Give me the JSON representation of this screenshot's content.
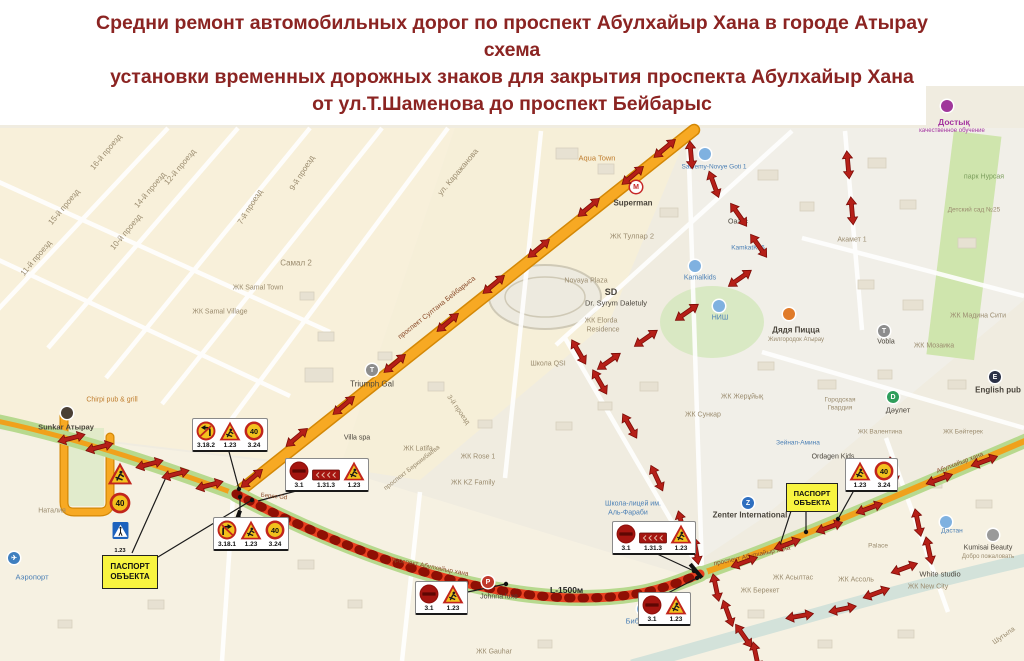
{
  "title": {
    "line1": "Средни ремонт автомобильных дорог по проспект Абулхайыр Хана в городе Атырау",
    "line2": "схема",
    "line3": "установки временных дорожных знаков для закрытия проспекта Абулхайыр Хана",
    "line4": "от ул.Т.Шаменова до проспект Бейбарыс"
  },
  "legend": {
    "passport_line1": "ПАСПОРТ",
    "passport_line2": "ОБЪЕКТА",
    "closure_length": "L-1500м"
  },
  "colors": {
    "title_text": "#8b2422",
    "road_closed": "#e8401f",
    "road_main_orange": "#f7a923",
    "road_verge_green": "#b7d98e",
    "detour_arrow": "#b51f18",
    "passport_bg": "#f8f440",
    "sign_temporary_bg": "#f2c11d",
    "sign_red": "#c1251c"
  },
  "roads": {
    "beibarys": "проспект Султана Бейбарыса",
    "abulkhair": "проспект Абулхайыр хана"
  },
  "sign_clusters": [
    {
      "x": 192,
      "y": 418,
      "signs": [
        {
          "t": "no-left-turn",
          "n": "3.18.2"
        },
        {
          "t": "roadworks",
          "n": "1.23"
        },
        {
          "t": "speed",
          "n": "3.24",
          "v": "40"
        }
      ]
    },
    {
      "x": 285,
      "y": 458,
      "signs": [
        {
          "t": "no-entry",
          "n": "3.1"
        },
        {
          "t": "panel",
          "n": "1.31.3"
        },
        {
          "t": "roadworks",
          "n": "1.23"
        }
      ]
    },
    {
      "x": 213,
      "y": 517,
      "signs": [
        {
          "t": "no-right-turn",
          "n": "3.18.1"
        },
        {
          "t": "roadworks",
          "n": "1.23"
        },
        {
          "t": "speed",
          "n": "3.24",
          "v": "40"
        }
      ]
    },
    {
      "x": 612,
      "y": 521,
      "signs": [
        {
          "t": "no-entry",
          "n": "3.1"
        },
        {
          "t": "panel",
          "n": "1.31.3"
        },
        {
          "t": "roadworks",
          "n": "1.23"
        }
      ]
    },
    {
      "x": 415,
      "y": 581,
      "signs": [
        {
          "t": "no-entry",
          "n": "3.1"
        },
        {
          "t": "roadworks",
          "n": "1.23"
        }
      ]
    },
    {
      "x": 638,
      "y": 592,
      "signs": [
        {
          "t": "no-entry",
          "n": "3.1"
        },
        {
          "t": "roadworks",
          "n": "1.23"
        }
      ]
    },
    {
      "x": 845,
      "y": 458,
      "signs": [
        {
          "t": "roadworks",
          "n": "1.23"
        },
        {
          "t": "speed",
          "n": "3.24",
          "v": "40"
        }
      ]
    }
  ],
  "sign_stack": {
    "x": 107,
    "y": 462,
    "signs": [
      {
        "t": "roadworks",
        "n": "1.23"
      },
      {
        "t": "speed",
        "n": "3.24",
        "v": "40"
      },
      {
        "t": "ped-crossing",
        "n": "5.19.1"
      }
    ],
    "list": [
      "1.23",
      "3.24",
      "5.19.1"
    ]
  },
  "passport_boxes": [
    {
      "x": 102,
      "y": 555,
      "w": 54,
      "h": 32
    },
    {
      "x": 786,
      "y": 483,
      "w": 50,
      "h": 27
    }
  ],
  "distance": {
    "x": 550,
    "y": 585
  },
  "labels": [
    {
      "t": "16-й проезд",
      "x": 106,
      "y": 152,
      "r": -50
    },
    {
      "t": "15-й проезд",
      "x": 64,
      "y": 207,
      "r": -50
    },
    {
      "t": "14-й проезд",
      "x": 150,
      "y": 190,
      "r": -50
    },
    {
      "t": "12-й проезд",
      "x": 180,
      "y": 167,
      "r": -50
    },
    {
      "t": "11-й проезд",
      "x": 36,
      "y": 258,
      "r": -50
    },
    {
      "t": "10-й проезд",
      "x": 126,
      "y": 232,
      "r": -50
    },
    {
      "t": "9-й проезд",
      "x": 302,
      "y": 173,
      "r": -58
    },
    {
      "t": "7-й проезд",
      "x": 250,
      "y": 207,
      "r": -58
    },
    {
      "t": "Самал 2",
      "x": 296,
      "y": 263
    },
    {
      "t": "ЖК Samal Town",
      "x": 258,
      "y": 288,
      "fs": 7
    },
    {
      "t": "ЖК Samal Village",
      "x": 220,
      "y": 312,
      "fs": 7
    },
    {
      "t": "ул. Каражанова",
      "x": 458,
      "y": 172,
      "r": -50
    },
    {
      "t": "Aqua Town",
      "x": 597,
      "y": 158,
      "c": "poi",
      "fs": 7.5
    },
    {
      "t": "Superman",
      "x": 633,
      "y": 203,
      "c": "dk",
      "b": 1,
      "fs": 8
    },
    {
      "t": "Saulemy-Novye Goti 1",
      "x": 714,
      "y": 167,
      "c": "bl",
      "fs": 6.5
    },
    {
      "t": "ЖК Тулпар 2",
      "x": 632,
      "y": 236,
      "fs": 7.5
    },
    {
      "t": "Оазис",
      "x": 738,
      "y": 222,
      "c": "dk",
      "fs": 7
    },
    {
      "t": "Kamalkids",
      "x": 700,
      "y": 278,
      "c": "bl",
      "fs": 7
    },
    {
      "t": "Novaya Plaza",
      "x": 586,
      "y": 281,
      "fs": 7
    },
    {
      "t": "KamkatK06",
      "x": 748,
      "y": 248,
      "c": "bl",
      "fs": 6.5
    },
    {
      "t": "Акамет 1",
      "x": 852,
      "y": 240,
      "fs": 7
    },
    {
      "t": "Достық",
      "x": 954,
      "y": 122,
      "c": "pu",
      "b": 1,
      "fs": 8.5
    },
    {
      "t": "качественное обучение",
      "x": 952,
      "y": 131,
      "c": "pu",
      "fs": 6
    },
    {
      "t": "парк Нурсая",
      "x": 984,
      "y": 177,
      "c": "grn",
      "fs": 7
    },
    {
      "t": "Детский сад №25",
      "x": 974,
      "y": 210,
      "fs": 6.5
    },
    {
      "t": "ЖК Мәдина Сити",
      "x": 978,
      "y": 316,
      "fs": 7
    },
    {
      "t": "Vobla",
      "x": 886,
      "y": 342,
      "c": "dk",
      "fs": 7
    },
    {
      "t": "ЖК Мозаика",
      "x": 934,
      "y": 346,
      "fs": 7
    },
    {
      "t": "English pub",
      "x": 998,
      "y": 390,
      "c": "dk",
      "b": 1,
      "fs": 8
    },
    {
      "t": "Дәулет",
      "x": 898,
      "y": 410,
      "c": "dk",
      "fs": 7.5
    },
    {
      "t": "ЖК Валентина",
      "x": 880,
      "y": 432,
      "fs": 6.5
    },
    {
      "t": "ЖК Бәйтерек",
      "x": 963,
      "y": 432,
      "fs": 6.5
    },
    {
      "t": "Triumph Gal",
      "x": 372,
      "y": 384,
      "c": "dk",
      "fs": 8
    },
    {
      "t": "Villa spa",
      "x": 357,
      "y": 438,
      "c": "dk",
      "fs": 7
    },
    {
      "t": "ЖК Latifa",
      "x": 418,
      "y": 449,
      "fs": 7
    },
    {
      "t": "ЖК Rose 1",
      "x": 478,
      "y": 457,
      "fs": 7
    },
    {
      "t": "3-й проезд",
      "x": 458,
      "y": 410,
      "r": 55,
      "fs": 7
    },
    {
      "t": "Школа QSI",
      "x": 548,
      "y": 364,
      "fs": 7
    },
    {
      "t": "SD",
      "x": 611,
      "y": 292,
      "c": "dk",
      "b": 1,
      "fs": 9
    },
    {
      "t": "Dr. Syrym Daletuly",
      "x": 616,
      "y": 303,
      "c": "dk",
      "fs": 7.5
    },
    {
      "t": "ЖК Elorda",
      "x": 601,
      "y": 321,
      "fs": 7
    },
    {
      "t": "Residence",
      "x": 603,
      "y": 330,
      "fs": 7
    },
    {
      "t": "НИШ",
      "x": 720,
      "y": 318,
      "c": "bl",
      "fs": 7
    },
    {
      "t": "Дядя Пицца",
      "x": 796,
      "y": 330,
      "c": "dk",
      "b": 1,
      "fs": 8
    },
    {
      "t": "Жилгородок Атырау",
      "x": 796,
      "y": 340,
      "fs": 6
    },
    {
      "t": "ЖК Жерұйық",
      "x": 742,
      "y": 397,
      "fs": 7
    },
    {
      "t": "ЖК Сункар",
      "x": 703,
      "y": 415,
      "fs": 7
    },
    {
      "t": "Городская",
      "x": 840,
      "y": 400,
      "fs": 6.5
    },
    {
      "t": "Гвардия",
      "x": 840,
      "y": 408,
      "fs": 6.5
    },
    {
      "t": "Зейнап-Амина",
      "x": 798,
      "y": 443,
      "c": "bl",
      "fs": 6.5
    },
    {
      "t": "Ordagen Kids",
      "x": 833,
      "y": 457,
      "c": "dk",
      "fs": 7
    },
    {
      "t": "ЖК KZ Family",
      "x": 473,
      "y": 483,
      "fs": 7
    },
    {
      "t": "проспект Беркимбаева",
      "x": 412,
      "y": 468,
      "r": -38,
      "fs": 6.5
    },
    {
      "t": "Школа-лицей им.",
      "x": 633,
      "y": 504,
      "c": "bl",
      "fs": 7
    },
    {
      "t": "Аль-Фараби",
      "x": 628,
      "y": 513,
      "c": "bl",
      "fs": 7
    },
    {
      "t": "Zenter International",
      "x": 750,
      "y": 515,
      "c": "dk",
      "b": 1,
      "fs": 8
    },
    {
      "t": "Библиотека",
      "x": 646,
      "y": 621,
      "c": "bl",
      "fs": 7.5
    },
    {
      "t": "ЖК Gauhar",
      "x": 494,
      "y": 652,
      "fs": 7
    },
    {
      "t": "Johnna luxe",
      "x": 499,
      "y": 597,
      "c": "dk",
      "fs": 7
    },
    {
      "t": "ЖК Асылтас",
      "x": 793,
      "y": 578,
      "fs": 7
    },
    {
      "t": "ЖК Берекет",
      "x": 760,
      "y": 591,
      "fs": 7
    },
    {
      "t": "Дастан",
      "x": 952,
      "y": 531,
      "c": "bl",
      "fs": 6.5
    },
    {
      "t": "Palace",
      "x": 878,
      "y": 546,
      "fs": 6.5
    },
    {
      "t": "ЖК Ассоль",
      "x": 856,
      "y": 580,
      "fs": 7
    },
    {
      "t": "White studio",
      "x": 940,
      "y": 574,
      "c": "dk",
      "fs": 7.5
    },
    {
      "t": "ЖК New City",
      "x": 928,
      "y": 587,
      "fs": 7
    },
    {
      "t": "Kumisai Beauty",
      "x": 988,
      "y": 548,
      "c": "dk",
      "fs": 7
    },
    {
      "t": "Добро пожаловать",
      "x": 988,
      "y": 557,
      "fs": 6
    },
    {
      "t": "Шугыла",
      "x": 1004,
      "y": 636,
      "r": -35,
      "fs": 7
    },
    {
      "t": "Sunkar Атырау",
      "x": 66,
      "y": 427,
      "c": "dk",
      "b": 1,
      "fs": 7.5
    },
    {
      "t": "Chirpi pub & grill",
      "x": 112,
      "y": 400,
      "c": "poi",
      "fs": 7
    },
    {
      "t": "Наталия",
      "x": 52,
      "y": 511,
      "fs": 7
    },
    {
      "t": "Аэропорт",
      "x": 32,
      "y": 577,
      "c": "bl",
      "fs": 7.5
    },
    {
      "t": "Берес Gd",
      "x": 274,
      "y": 497,
      "c": "rd",
      "fs": 6,
      "r": 6
    },
    {
      "t": "проспект Султана Бейбарыса",
      "x": 437,
      "y": 308,
      "c": "rd",
      "r": -38.5,
      "fs": 7
    },
    {
      "t": "проспект Абулхайыр хана",
      "x": 430,
      "y": 567,
      "c": "rd",
      "r": 11,
      "fs": 6.5
    },
    {
      "t": "проспект Абулхайыр хана",
      "x": 752,
      "y": 556,
      "c": "rd",
      "r": -12,
      "fs": 6.5
    },
    {
      "t": "Абулхайыр хана",
      "x": 960,
      "y": 463,
      "c": "rd",
      "r": -21,
      "fs": 6.5
    }
  ],
  "pois": [
    {
      "g": "M",
      "x": 636,
      "y": 187,
      "bg": "#ffffff",
      "fg": "#c62828",
      "name": "metro-superman-icon"
    },
    {
      "g": "",
      "x": 947,
      "y": 106,
      "bg": "#a0379b",
      "name": "dostyk-icon"
    },
    {
      "g": "T",
      "x": 372,
      "y": 370,
      "bg": "#8d8d8d",
      "name": "triumph-icon"
    },
    {
      "g": "",
      "x": 789,
      "y": 314,
      "bg": "#e07b2a",
      "name": "pizza-icon"
    },
    {
      "g": "D",
      "x": 893,
      "y": 397,
      "bg": "#2e9e5b",
      "name": "daulet-icon"
    },
    {
      "g": "E",
      "x": 995,
      "y": 377,
      "bg": "#2b3147",
      "name": "english-pub-icon"
    },
    {
      "g": "Z",
      "x": 748,
      "y": 503,
      "bg": "#2f6fc0",
      "name": "zenter-icon"
    },
    {
      "g": "",
      "x": 643,
      "y": 609,
      "bg": "#7fb1e0",
      "name": "library-icon"
    },
    {
      "g": "✈",
      "x": 14,
      "y": 558,
      "bg": "#3f7fbf",
      "name": "airport-icon"
    },
    {
      "g": "",
      "x": 695,
      "y": 266,
      "bg": "#7fb1e0",
      "name": "kamalkids-icon"
    },
    {
      "g": "",
      "x": 705,
      "y": 154,
      "bg": "#7fb1e0",
      "name": "saulemy-icon"
    },
    {
      "g": "",
      "x": 719,
      "y": 306,
      "bg": "#7fb1e0",
      "name": "nish-icon"
    },
    {
      "g": "",
      "x": 993,
      "y": 535,
      "bg": "#9a9a9a",
      "name": "kumisai-icon"
    },
    {
      "g": "",
      "x": 946,
      "y": 522,
      "bg": "#7fb1e0",
      "name": "dastan-icon"
    },
    {
      "g": "",
      "x": 67,
      "y": 413,
      "bg": "#4a3f35",
      "name": "sunkar-icon"
    },
    {
      "g": "T",
      "x": 884,
      "y": 331,
      "bg": "#8d8d8d",
      "name": "vobla-icon"
    },
    {
      "g": "P",
      "x": 488,
      "y": 582,
      "bg": "#c0392b",
      "name": "johnna-luxe-icon"
    }
  ],
  "arrows": [
    [
      253,
      477,
      -40
    ],
    [
      298,
      436,
      -40
    ],
    [
      345,
      404,
      -40
    ],
    [
      396,
      362,
      -40
    ],
    [
      449,
      321,
      -40
    ],
    [
      495,
      283,
      -40
    ],
    [
      540,
      247,
      -40
    ],
    [
      590,
      206,
      -40
    ],
    [
      634,
      174,
      -40
    ],
    [
      666,
      147,
      -40
    ],
    [
      689,
      152,
      85
    ],
    [
      712,
      182,
      70
    ],
    [
      737,
      213,
      55
    ],
    [
      757,
      244,
      55
    ],
    [
      741,
      277,
      -35
    ],
    [
      688,
      311,
      -35
    ],
    [
      647,
      337,
      -35
    ],
    [
      610,
      360,
      -35
    ],
    [
      577,
      350,
      60
    ],
    [
      598,
      380,
      60
    ],
    [
      628,
      424,
      60
    ],
    [
      655,
      476,
      65
    ],
    [
      680,
      522,
      75
    ],
    [
      694,
      548,
      80
    ],
    [
      72,
      437,
      -15
    ],
    [
      100,
      446,
      -15
    ],
    [
      150,
      463,
      -15
    ],
    [
      176,
      473,
      -15
    ],
    [
      210,
      484,
      -15
    ],
    [
      745,
      561,
      -20
    ],
    [
      788,
      543,
      -20
    ],
    [
      830,
      526,
      -20
    ],
    [
      870,
      507,
      -20
    ],
    [
      940,
      478,
      -20
    ],
    [
      985,
      460,
      -20
    ],
    [
      891,
      468,
      78
    ],
    [
      916,
      520,
      78
    ],
    [
      927,
      548,
      78
    ],
    [
      905,
      567,
      -20
    ],
    [
      877,
      592,
      -20
    ],
    [
      843,
      608,
      -12
    ],
    [
      800,
      615,
      -10
    ],
    [
      714,
      585,
      78
    ],
    [
      726,
      611,
      70
    ],
    [
      742,
      634,
      55
    ],
    [
      754,
      653,
      78
    ],
    [
      846,
      162,
      85
    ],
    [
      850,
      208,
      85
    ]
  ]
}
